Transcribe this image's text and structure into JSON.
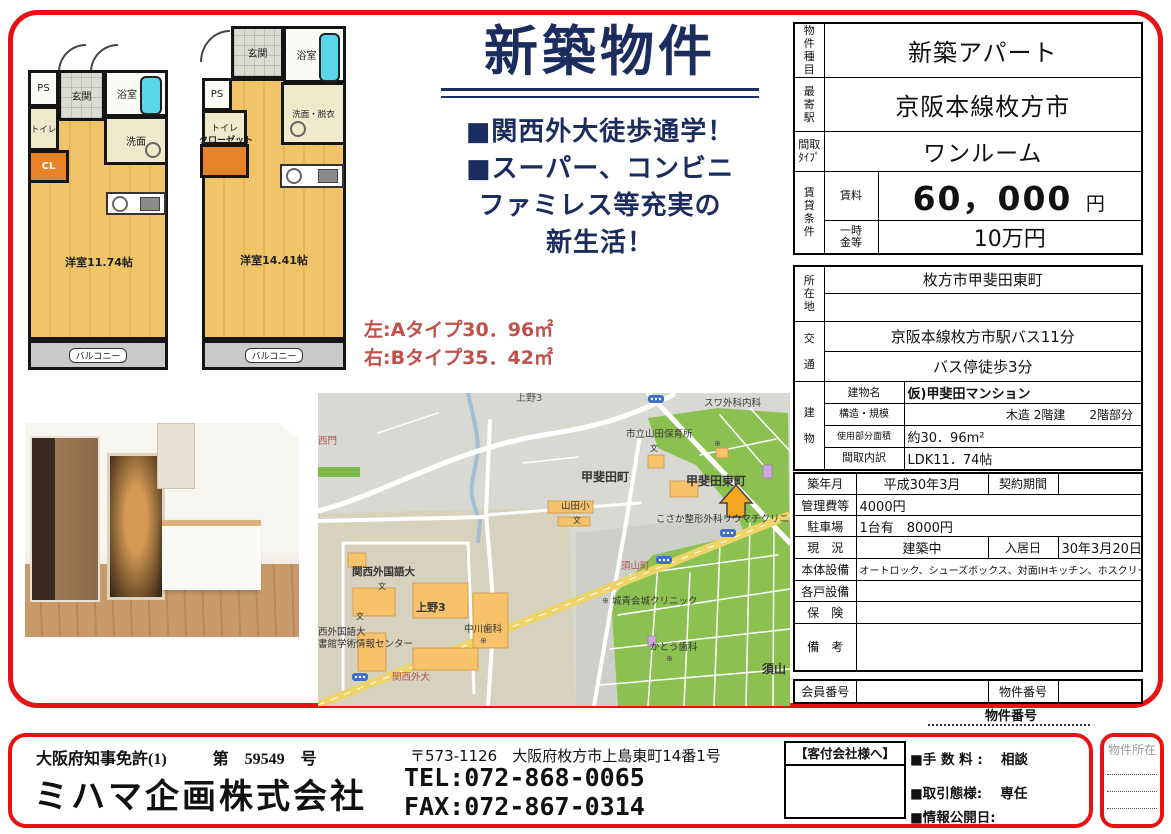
{
  "colors": {
    "frame_red": "#e81212",
    "headline_navy": "#1b2d5e",
    "type_salmon": "#c0504a",
    "map_green": "#8cc152",
    "map_road_yellow": "#eed466",
    "building_orange": "#f6c36b",
    "floor_wood": "#f0c468",
    "bathtub_cyan": "#59d7e8",
    "closet_orange": "#e8832a"
  },
  "headline": {
    "title": "新築物件",
    "line1": "■関西外大徒歩通学！",
    "line2": "■スーパー、コンビニ",
    "line3": "ファミレス等充実の",
    "line4": "新生活！",
    "type_a": "左:Aタイプ30．96㎡",
    "type_b": "右:Bタイプ35．42㎡"
  },
  "plan_a": {
    "ps": "PS",
    "genkan": "玄関",
    "bath": "浴室",
    "toilet": "トイレ",
    "wash": "洗面",
    "closet": "CL",
    "room": "洋室11.74帖",
    "balcony": "バルコニー"
  },
  "plan_b": {
    "ps": "PS",
    "genkan": "玄関",
    "bath": "浴室",
    "toilet": "トイレ",
    "wash": "洗面・脱衣",
    "closet": "クローゼット",
    "room": "洋室14.41帖",
    "balcony": "バルコニー"
  },
  "spec": {
    "property_type_label": "物\n件\n種\n目",
    "property_type": "新築アパート",
    "station_label": "最\n寄\n駅",
    "station": "京阪本線枚方市",
    "layout_label": "間取\nﾀｲﾌﾟ",
    "layout": "ワンルーム",
    "rent_section_label": "賃\n貸\n条\n件",
    "rent_label": "賃料",
    "rent_value": "60，000",
    "rent_unit": "円",
    "deposit_label": "一時\n金等",
    "deposit_value": "10万円",
    "address_label": "所\n在\n地",
    "address_line1": "枚方市甲斐田東町",
    "address_line2": "",
    "access_label": "交\n\n通",
    "access_line1": "京阪本線枚方市駅バス11分",
    "access_line2": "バス停徒歩3分",
    "building_label": "建\n\n物",
    "building_name_label": "建物名",
    "building_name": "仮)甲斐田マンション",
    "structure_label": "構造・規模",
    "structure_value": "木造 2階建　　2階部分",
    "area_label": "使用部分面積",
    "area_value": "約30．96m²",
    "layout_detail_label": "間取内訳",
    "layout_detail_value": "LDK11．74帖",
    "built_label": "築年月",
    "built_value": "平成30年3月",
    "contract_label": "契約期間",
    "contract_value": "",
    "management_label": "管理費等",
    "management_value": "4000円",
    "parking_label": "駐車場",
    "parking_value": "1台有　8000円",
    "status_label": "現　況",
    "status_value": "建築中",
    "movein_label": "入居日",
    "movein_value": "30年3月20日",
    "equipment_label": "本体設備",
    "equipment_value": "オートロック、シューズボックス、対面IHキッチン、ホスクリーン",
    "unit_equipment_label": "各戸設備",
    "unit_equipment_value": "",
    "insurance_label": "保　険",
    "insurance_value": "",
    "remarks_label": "備　考",
    "remarks_value": "",
    "member_no_label": "会員番号",
    "member_no_value": "",
    "property_no_label": "物件番号",
    "property_no_value": ""
  },
  "map": {
    "labels": {
      "ueno3_top": "上野3",
      "nishimon": "西門",
      "suwa_clinic": "スワ外科内科",
      "hoikusho": "市立山田保育所",
      "kaida_cho": "甲斐田町",
      "kaida_higashi_cho": "甲斐田東町",
      "yamada_sho": "山田小",
      "kosaka_clinic": "こさか整形外科リウマチクリニック",
      "kansai_gaidai": "関西外国語大",
      "ueno3": "上野3",
      "library_line1": "西外国語大",
      "library_line2": "書館学術情報センター",
      "nakagawa_dental": "中川歯科",
      "bus_kansai_gaidai": "関西外大",
      "bus_suyama_cho": "須山町",
      "joseikai_clinic": "城青会城クリニック",
      "kato_dental": "かとう歯科",
      "suyama": "須山",
      "school_mark": "文",
      "hospital_mark": "⊕"
    }
  },
  "property_no_caption": "物件番号",
  "footer": {
    "license": "大阪府知事免許(1)",
    "license_no": "第　59549　号",
    "company": "ミハマ企画株式会社",
    "address": "〒573-1126　大阪府枚方市上島東町14番1号",
    "tel": "TEL:072-868-0065",
    "fax": "FAX:072-867-0314",
    "agent_title": "【客付会社様へ】",
    "fee": "■手 数 料 :　 相談",
    "dealing": "■取引態様:　 専任",
    "disclosure": "■情報公開日:",
    "location_label": "物件所在"
  }
}
